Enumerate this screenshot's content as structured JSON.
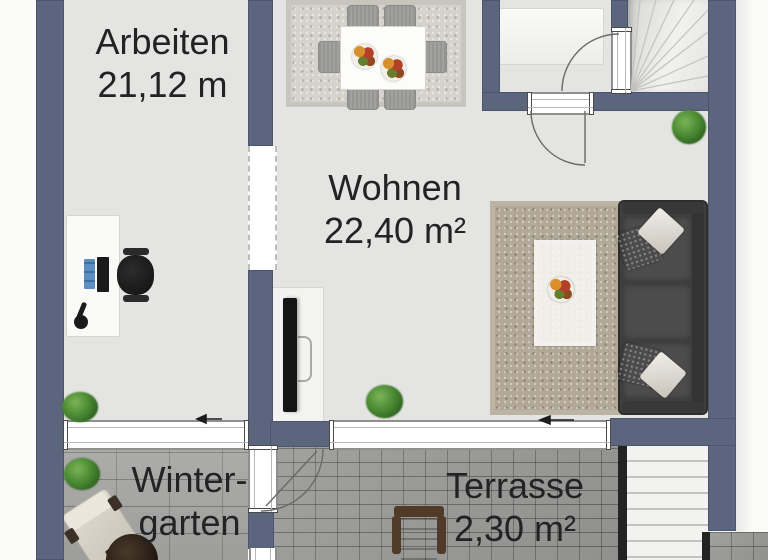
{
  "type": "floorplan",
  "rooms": {
    "arbeiten": {
      "label": "Arbeiten",
      "area": "21,12 m"
    },
    "wohnen": {
      "label": "Wohnen",
      "area": "22,40 m²"
    },
    "wintergarten": {
      "line1": "Winter-",
      "line2": "garten"
    },
    "terrasse": {
      "label": "Terrasse",
      "area": "2,30 m²"
    }
  },
  "colors": {
    "wall": "#5b657e",
    "interior_floor": "#e4e4e2",
    "wintergarten_floor": "#a7a7a5",
    "terrasse_floor": "#9b9b99",
    "label_text": "#232323"
  },
  "icons": [
    "plant-icon",
    "door-swing-icon",
    "slide-arrow-icon",
    "stairs-icon"
  ]
}
